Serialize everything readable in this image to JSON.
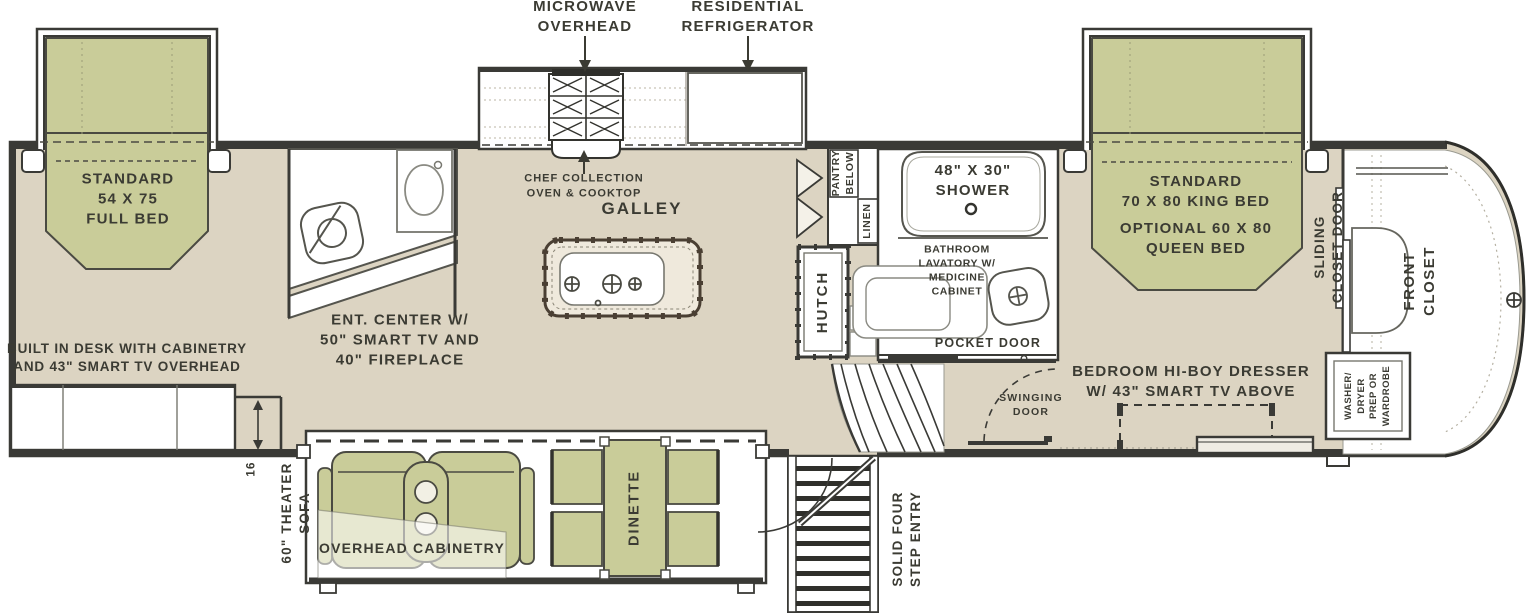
{
  "meta": {
    "title": "RV floor plan diagram"
  },
  "colors": {
    "background": "#FFFFFF",
    "floor_tan": "#DCD4C2",
    "upholstery_green": "#C9CC99",
    "wall_line": "#3A3A36",
    "island_border": "#4A3F33",
    "fixture_line": "#777770",
    "text": "#3B3B33"
  },
  "labels": {
    "microwave": "MICROWAVE\nOVERHEAD",
    "refrigerator": "RESIDENTIAL\nREFRIGERATOR",
    "chef": "CHEF COLLECTION\nOVEN & COOKTOP",
    "galley": "GALLEY",
    "full_bed": "STANDARD\n54 X 75\nFULL BED",
    "desk": "BUILT IN DESK WITH CABINETRY\nAND 43\" SMART TV OVERHEAD",
    "ent_center": "ENT. CENTER W/\n50\" SMART TV AND\n40\" FIREPLACE",
    "pantry": "PANTRY\nBELOW",
    "linen": "LINEN",
    "hutch": "HUTCH",
    "shower": "48\" X 30\"\nSHOWER",
    "lavatory": "BATHROOM\nLAVATORY W/\nMEDICINE\nCABINET",
    "pocket_door": "POCKET DOOR",
    "swinging_door": "SWINGING\nDOOR",
    "king_bed": "STANDARD\n70 X 80 KING BED",
    "queen_bed": "OPTIONAL 60 X 80\nQUEEN BED",
    "sliding_closet_door": "SLIDING\nCLOSET DOOR",
    "front_closet": "FRONT CLOSET",
    "washer": "WASHER/\nDRYER\nPREP OR\nWARDROBE",
    "dresser": "BEDROOM HI-BOY DRESSER\nW/ 43\" SMART TV ABOVE",
    "theater_sofa": "60\" THEATER\nSOFA",
    "overhead_cab": "OVERHEAD CABINETRY",
    "dinette": "DINETTE",
    "entry": "SOLID FOUR\nSTEP ENTRY",
    "dim16": "16"
  }
}
